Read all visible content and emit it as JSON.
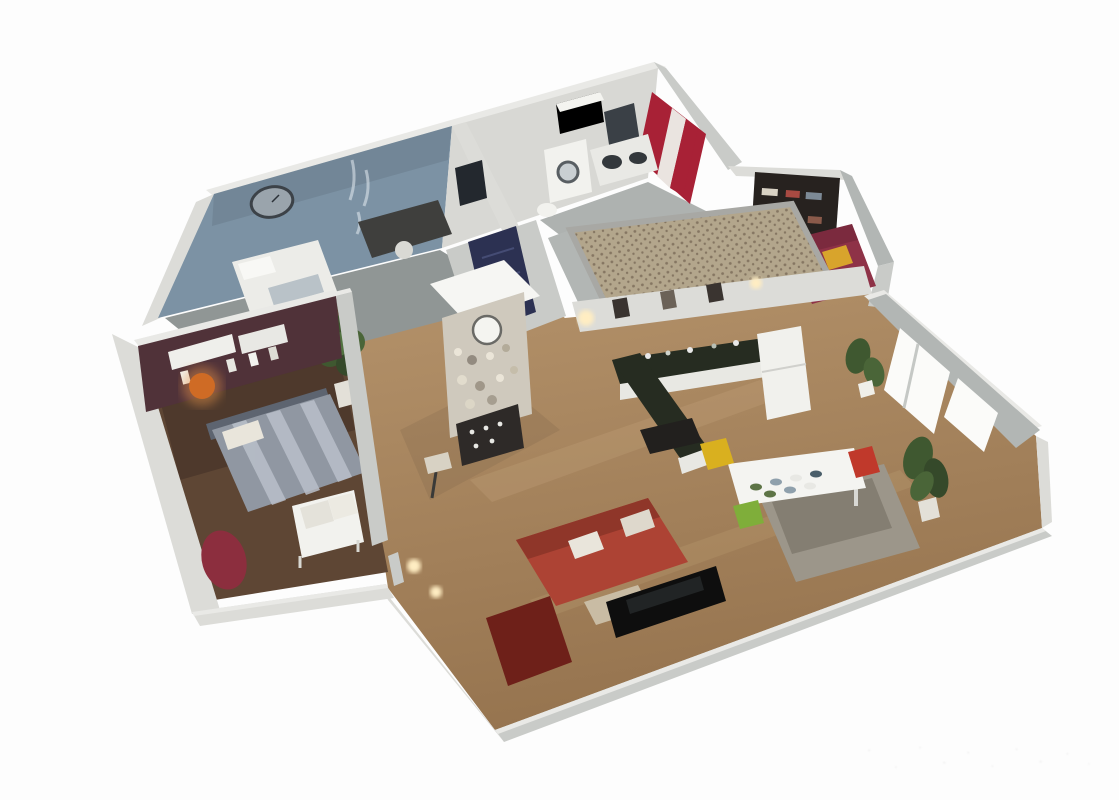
{
  "scene": {
    "type": "3d-floor-plan-render",
    "view": "isometric-cutaway-top",
    "description": "Photorealistic 3D cutaway rendering of a two-bedroom apartment floor plan on a white background",
    "rooms": [
      {
        "name": "master-bedroom",
        "position": "lower-left",
        "walls": "dark-plum",
        "furniture": [
          "double-bed-gray-striped",
          "white-wall-shelf",
          "orange-wall-lamp",
          "white-bench-seat",
          "red-beanbag"
        ]
      },
      {
        "name": "blue-bedroom",
        "position": "upper-left",
        "walls": "slate-blue",
        "furniture": [
          "oval-wall-clock",
          "wall-decal",
          "dark-desk",
          "white-bed",
          "picture-frame"
        ]
      },
      {
        "name": "bathroom-laundry",
        "position": "top-center",
        "furniture": [
          "washing-machine",
          "vanity-twin-basins",
          "dark-mirror",
          "red-striped-curtain",
          "wall-shelf"
        ]
      },
      {
        "name": "reading-nook",
        "position": "upper-right",
        "furniture": [
          "bookshelf",
          "red-chaise",
          "yellow-cushion"
        ]
      },
      {
        "name": "kitchen",
        "position": "center",
        "furniture": [
          "lattice-canopy",
          "l-shaped-dark-counter",
          "refrigerator",
          "wall-art",
          "dark-bench"
        ]
      },
      {
        "name": "dining-area",
        "position": "center-right",
        "furniture": [
          "white-dining-table",
          "place-settings",
          "yellow-chair",
          "red-chair",
          "green-chair",
          "gray-sofa-back"
        ]
      },
      {
        "name": "living-room",
        "position": "bottom-center",
        "furniture": [
          "red-sofa-white-pillows",
          "flat-screen-tv",
          "tv-stand",
          "dark-red-rug",
          "table-lamp",
          "wall-sconces"
        ]
      },
      {
        "name": "hallway",
        "position": "center-left",
        "furniture": [
          "display-cabinet-with-clock",
          "navy-door-panel",
          "potted-plant"
        ]
      },
      {
        "name": "window-wall",
        "position": "right",
        "furniture": [
          "floor-to-ceiling-windows",
          "potted-plants"
        ]
      }
    ]
  },
  "colors": {
    "bg": "#fdfdfd",
    "wallTop": "#e9e9e6",
    "wallFace": "#c9cbc8",
    "wallFaceLight": "#dcdcd8",
    "wallFaceDark": "#b2b6b4",
    "blueWall": "#7c92a4",
    "backWallWhite": "#d8d8d4",
    "maroonWall": "#503239",
    "bedroomFloor": "#5e4634",
    "grayFloor": "#909695",
    "bathFloor": "#aeb2b0",
    "wood1": "#b6946c",
    "wood2": "#96744f",
    "woodStreak": "#c6a77d",
    "counterTop": "#262c21",
    "cabinetWhite": "#e8e8e3",
    "fridge": "#f1f1ed",
    "curtainRed": "#a82136",
    "curtainWhite": "#eae4e0",
    "bookshelf": "#27221f",
    "chaise": "#8e3247",
    "cushionYellow": "#d8a42c",
    "windowWhite": "#fbfbf9",
    "sofaRed": "#ad4334",
    "sofaRedDark": "#8f3629",
    "pillowWhite": "#e9e5db",
    "tv": "#0e0e0e",
    "tvStand": "#c9bca4",
    "rug": "#6e2019",
    "sofaGray": "#9c968a",
    "sofaGrayDark": "#847e72",
    "tableWhite": "#f4f4f1",
    "chairYellow": "#d9b01f",
    "chairRed": "#c0392b",
    "chairGreen": "#7fae3a",
    "bedGray": "#9097a2",
    "bedStripe": "#bac0ca",
    "headboard": "#5d6470",
    "benchWhite": "#f2f2ee",
    "beanbag": "#8c2e3e",
    "lampOrange": "#cf6b25",
    "lampGlow": "#ffedc2",
    "navyDoor": "#2c3152",
    "plant": "#3f5830",
    "plantPot": "#e3e0d8",
    "latticeBg": "#b3a68c",
    "latticeDot": "#857662",
    "cabinetBody": "#cfc9bd",
    "darkBase": "#2e2a28",
    "clockFace": "#9aa4ac",
    "clockRim": "#3c4248",
    "mirrorDark": "#3a4046",
    "frameDark": "#23282e",
    "deskDark": "#3f3f3d"
  },
  "dining": {
    "plates": [
      "#5d7446",
      "#8fa0ac",
      "#e8e8e4",
      "#4a5e6a",
      "#5d7446",
      "#8fa0ac",
      "#e8e8e4"
    ]
  },
  "watermark": {
    "present": true,
    "legible": false
  }
}
